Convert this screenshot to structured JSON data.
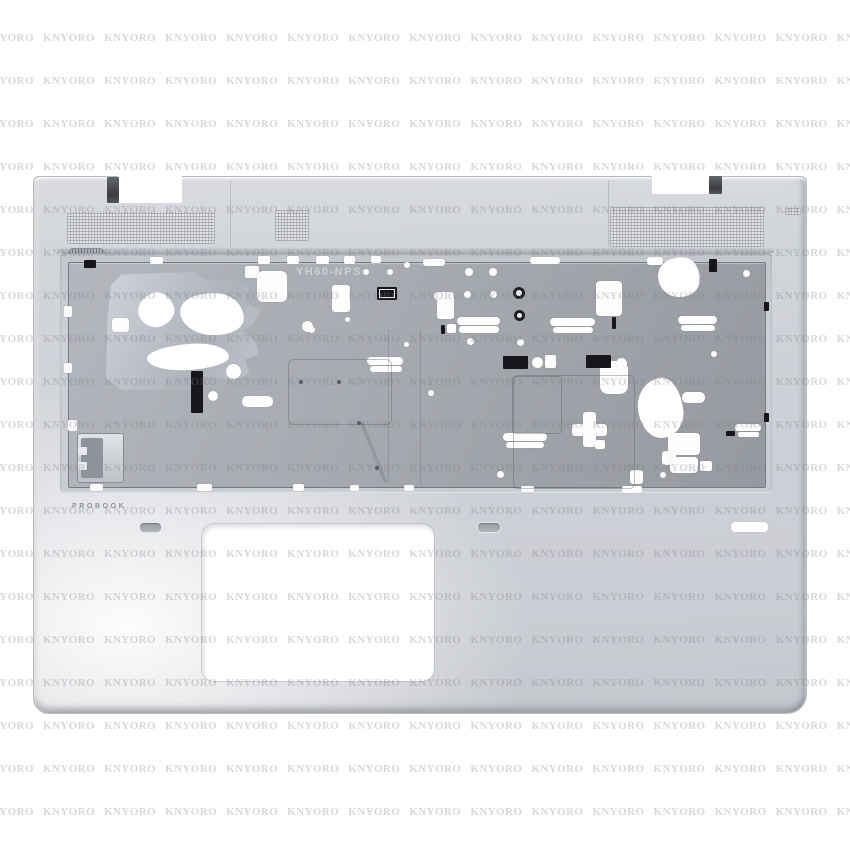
{
  "watermark": {
    "text": "KNYORO"
  },
  "labels": {
    "brand_text": "PROBOOK",
    "mold_marking": "YH60-NPS"
  },
  "colors": {
    "background": "#ffffff",
    "body_silver": "#cfd2d8",
    "deck_gray": "#a4a7ad",
    "shield_gray": "#bcc0c7",
    "tape_black": "#17171b",
    "watermark_gray": "#d4d4d8"
  }
}
